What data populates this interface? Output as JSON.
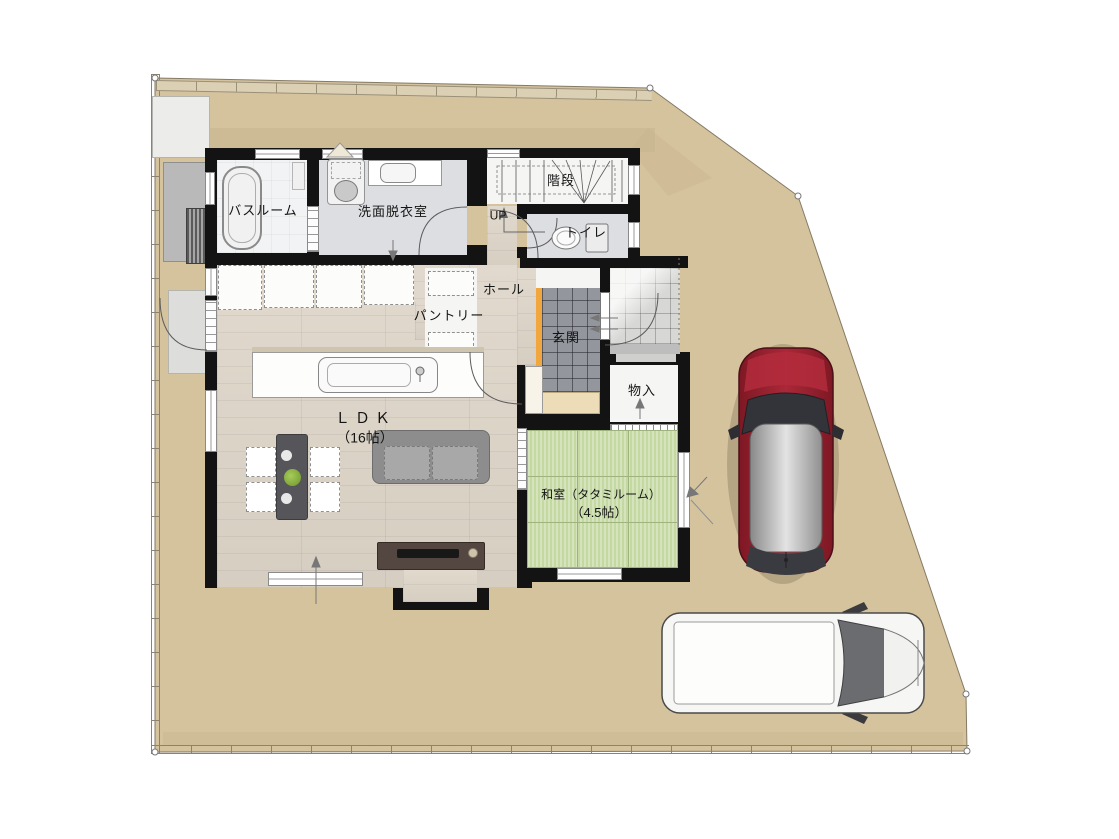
{
  "plan": {
    "title": "1F floor plan",
    "labels": {
      "bathroom": "バスルーム",
      "washroom": "洗面脱衣室",
      "stairs": "階段",
      "stairs_direction": "UP",
      "toilet": "トイレ",
      "hall": "ホール",
      "pantry": "パントリー",
      "entrance": "玄関",
      "storage": "物入",
      "ldk_name": "ＬＤＫ",
      "ldk_size": "（16帖）",
      "tatami_name": "和室（タタミルーム）",
      "tatami_size": "（4.5帖）"
    },
    "colors": {
      "lot_ground": "#d5c39e",
      "wall": "#131313",
      "wood_floor": "#dcd4c8",
      "tatami_green": "#c4d8a2",
      "entrance_tile_gray": "#93969c",
      "porch_tile_gray": "#d7d7d5",
      "step_accent_orange": "#f2a63e",
      "washroom_floor": "#dcdee1",
      "car_red": "#9e2433",
      "van_white": "#f6f6f4",
      "tv_board_brown": "#544640"
    },
    "vehicles": [
      {
        "name": "red-car-top-view"
      },
      {
        "name": "white-minivan-top-view"
      }
    ]
  }
}
